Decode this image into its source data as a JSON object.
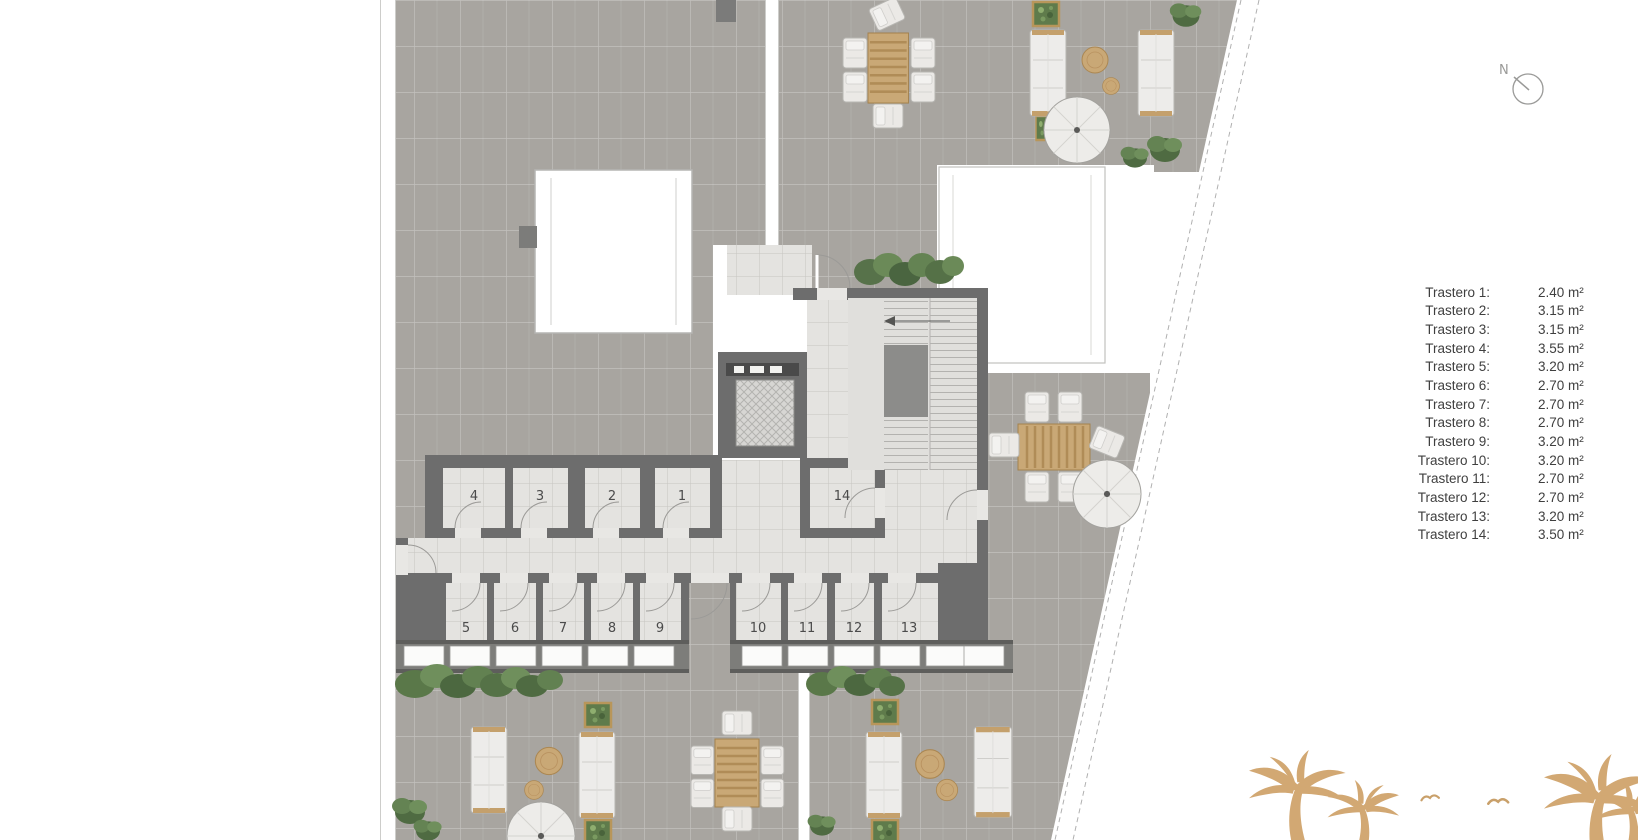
{
  "legend": {
    "items": [
      {
        "label": "Trastero 1:",
        "area": "2.40 m²"
      },
      {
        "label": "Trastero 2:",
        "area": "3.15 m²"
      },
      {
        "label": "Trastero 3:",
        "area": "3.15 m²"
      },
      {
        "label": "Trastero 4:",
        "area": "3.55 m²"
      },
      {
        "label": "Trastero 5:",
        "area": "3.20 m²"
      },
      {
        "label": "Trastero 6:",
        "area": "2.70 m²"
      },
      {
        "label": "Trastero 7:",
        "area": "2.70 m²"
      },
      {
        "label": "Trastero 8:",
        "area": "2.70 m²"
      },
      {
        "label": "Trastero 9:",
        "area": "3.20 m²"
      },
      {
        "label": "Trastero 10:",
        "area": "3.20 m²"
      },
      {
        "label": "Trastero 11:",
        "area": "2.70 m²"
      },
      {
        "label": "Trastero 12:",
        "area": "2.70 m²"
      },
      {
        "label": "Trastero 13:",
        "area": "3.20 m²"
      },
      {
        "label": "Trastero 14:",
        "area": "3.50 m²"
      }
    ]
  },
  "compass": {
    "label": "N"
  },
  "plan": {
    "rooms": [
      {
        "number": "1"
      },
      {
        "number": "2"
      },
      {
        "number": "3"
      },
      {
        "number": "4"
      },
      {
        "number": "5"
      },
      {
        "number": "6"
      },
      {
        "number": "7"
      },
      {
        "number": "8"
      },
      {
        "number": "9"
      },
      {
        "number": "10"
      },
      {
        "number": "11"
      },
      {
        "number": "12"
      },
      {
        "number": "13"
      },
      {
        "number": "14"
      }
    ]
  },
  "colors": {
    "terrace": "#a8a5a0",
    "wall": "#6d6d6d",
    "floor": "#e4e3e0",
    "wood": "#c9a876",
    "plant": "#5e7d4b",
    "palm": "#d2a873",
    "boundary_dash": "#b0b0b0"
  }
}
